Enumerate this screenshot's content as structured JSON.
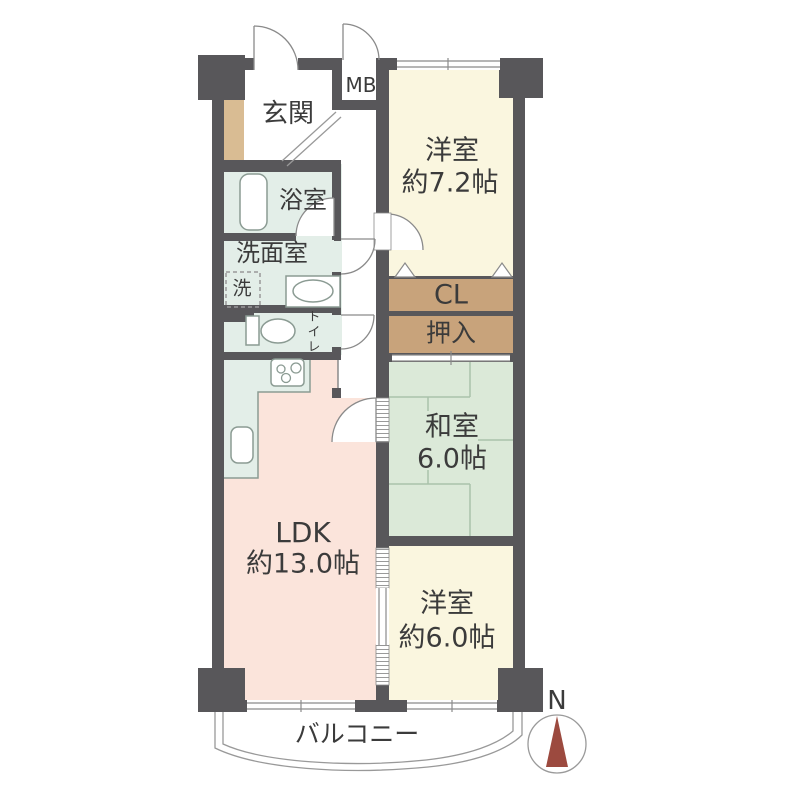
{
  "floorplan": {
    "entrance": {
      "label": "玄関"
    },
    "meter_box": {
      "label": "MB"
    },
    "western_room_1": {
      "name": "洋室",
      "size": "約7.2帖"
    },
    "bathroom": {
      "label": "浴室"
    },
    "washroom": {
      "label": "洗面室"
    },
    "washer": {
      "label": "洗"
    },
    "toilet": {
      "label": "トイレ"
    },
    "closet": {
      "label": "CL"
    },
    "oshiire": {
      "label": "押入"
    },
    "japanese_room": {
      "name": "和室",
      "size": "6.0帖"
    },
    "ldk": {
      "name": "LDK",
      "size": "約13.0帖"
    },
    "western_room_2": {
      "name": "洋室",
      "size": "約6.0帖"
    },
    "balcony": {
      "label": "バルコニー"
    },
    "compass": {
      "label": "N"
    }
  },
  "colors": {
    "wall": "#58575a",
    "western-floor": "#faf6df",
    "wet-floor": "#e3eee8",
    "tatami-floor": "#dbe9d8",
    "ldk-floor": "#fbe4db",
    "closet-floor": "#c8a37b",
    "entrance-step": "#d9bc93",
    "outline": "#8b9b93",
    "thin-line": "#999999",
    "needle": "#9c4a3f",
    "text": "#3b3b3b"
  }
}
